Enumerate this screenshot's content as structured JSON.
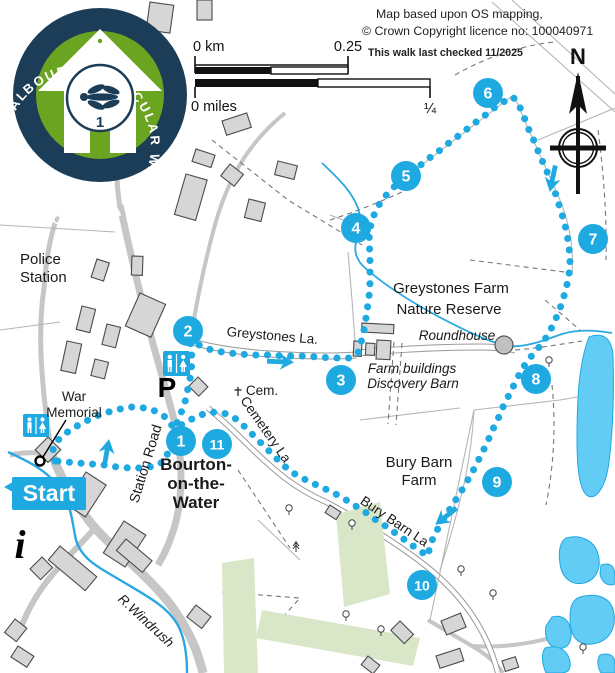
{
  "header": {
    "credit_line1": "Map based upon OS mapping,",
    "credit_line2": "© Crown Copyright licence no: 100040971",
    "checked": "This walk last checked 11/2025"
  },
  "scalebar": {
    "km_zero": "0 km",
    "km_max": "0.25",
    "miles_zero": "0 miles",
    "miles_max": "¼"
  },
  "compass": {
    "label": "N"
  },
  "badge": {
    "ring_text": "BOURTON CIRCULAR WALK • BOURTON CIRCULAR WALK •",
    "number": "1"
  },
  "start_label": "Start",
  "colors": {
    "route": "#1fa9e1",
    "lake": "#63ccf5",
    "green_area": "#d9e7c8",
    "building": "#d6d6d6",
    "road": "#c6c6c6",
    "badge_navy": "#1c3d57",
    "badge_green": "#6aa421"
  },
  "waypoints": [
    {
      "n": "1",
      "x": 181,
      "y": 441
    },
    {
      "n": "2",
      "x": 188,
      "y": 331
    },
    {
      "n": "3",
      "x": 341,
      "y": 380
    },
    {
      "n": "4",
      "x": 356,
      "y": 228
    },
    {
      "n": "5",
      "x": 406,
      "y": 176
    },
    {
      "n": "6",
      "x": 488,
      "y": 93
    },
    {
      "n": "7",
      "x": 593,
      "y": 239
    },
    {
      "n": "8",
      "x": 536,
      "y": 379
    },
    {
      "n": "9",
      "x": 497,
      "y": 482
    },
    {
      "n": "10",
      "x": 422,
      "y": 585
    },
    {
      "n": "11",
      "x": 217,
      "y": 444
    }
  ],
  "map_labels": [
    {
      "text": "Police",
      "x": 20,
      "y": 264,
      "size": 15,
      "cls": "lbl"
    },
    {
      "text": "Station",
      "x": 20,
      "y": 282,
      "size": 15,
      "cls": "lbl"
    },
    {
      "text": "War",
      "x": 74,
      "y": 401,
      "size": 13.5,
      "cls": "lbl",
      "anchor": "middle"
    },
    {
      "text": "Memorial",
      "x": 74,
      "y": 417,
      "size": 13.5,
      "cls": "lbl",
      "anchor": "middle"
    },
    {
      "text": "Bourton-",
      "x": 196,
      "y": 470,
      "size": 17,
      "cls": "lbl-bold",
      "anchor": "middle"
    },
    {
      "text": "on-the-",
      "x": 196,
      "y": 489,
      "size": 17,
      "cls": "lbl-bold",
      "anchor": "middle"
    },
    {
      "text": "Water",
      "x": 196,
      "y": 508,
      "size": 17,
      "cls": "lbl-bold",
      "anchor": "middle"
    },
    {
      "text": "Station Road",
      "x": 150,
      "y": 465,
      "size": 14,
      "cls": "lbl",
      "anchor": "middle",
      "rot": -73
    },
    {
      "text": "Greystones La.",
      "x": 272,
      "y": 340,
      "size": 13.5,
      "cls": "lbl",
      "anchor": "middle",
      "rot": 5
    },
    {
      "text": "Cem.",
      "x": 262,
      "y": 395,
      "size": 13.5,
      "cls": "lbl",
      "anchor": "middle"
    },
    {
      "text": "Cemetery La",
      "x": 262,
      "y": 432,
      "size": 13.5,
      "cls": "lbl",
      "anchor": "middle",
      "rot": 55
    },
    {
      "text": "Greystones Farm",
      "x": 451,
      "y": 293,
      "size": 15,
      "cls": "lbl",
      "anchor": "middle"
    },
    {
      "text": "Nature Reserve",
      "x": 449,
      "y": 314,
      "size": 15,
      "cls": "lbl",
      "anchor": "middle"
    },
    {
      "text": "Roundhouse",
      "x": 457,
      "y": 340,
      "size": 13.5,
      "cls": "lbl-italic",
      "anchor": "middle"
    },
    {
      "text": "Farm buildings",
      "x": 412,
      "y": 373,
      "size": 13.5,
      "cls": "lbl-italic",
      "anchor": "middle"
    },
    {
      "text": "Discovery Barn",
      "x": 413,
      "y": 388,
      "size": 13.5,
      "cls": "lbl-italic",
      "anchor": "middle"
    },
    {
      "text": "Bury Barn",
      "x": 419,
      "y": 467,
      "size": 15,
      "cls": "lbl",
      "anchor": "middle"
    },
    {
      "text": "Farm",
      "x": 419,
      "y": 485,
      "size": 15,
      "cls": "lbl",
      "anchor": "middle"
    },
    {
      "text": "Bury Barn La",
      "x": 392,
      "y": 525,
      "size": 13.5,
      "cls": "lbl",
      "anchor": "middle",
      "rot": 34
    },
    {
      "text": "R.Windrush",
      "x": 143,
      "y": 624,
      "size": 13.5,
      "cls": "lbl-italic",
      "anchor": "middle",
      "rot": 43
    },
    {
      "text": "P",
      "x": 167,
      "y": 397,
      "size": 28,
      "cls": "lbl-heavy",
      "anchor": "middle"
    },
    {
      "text": "i",
      "x": 20,
      "y": 558,
      "size": 40,
      "cls": "lbl-info",
      "anchor": "middle"
    }
  ],
  "route": {
    "color": "#1fa9e1",
    "main_path": "M 55,461 L 53,449 L 59,439 L 70,430 L 84,422 L 99,415 L 115,410 L 131,407 L 146,408 L 158,412 L 168,419 L 174,429 L 180,416 L 185,402 L 188,388 L 191,374 L 192,360 L 191,346 L 189,335 L 197,344 L 208,349 L 222,352 L 238,354 L 254,355 L 270,355 L 286,356 L 302,356 L 318,357 L 334,358 L 349,358 L 358,353 L 362,339 L 365,325 L 367,311 L 369,297 L 370,283 L 370,269 L 370,255 L 369,241 L 370,228 L 374,215 L 380,203 L 388,193 L 397,184 L 406,177 L 417,168 L 428,159 L 439,151 L 450,142 L 461,134 L 472,125 L 483,117 L 494,108 L 505,101 L 513,97 L 519,105 L 524,117 L 529,130 L 535,143 L 540,156 L 546,169 L 551,182 L 556,195 L 560,208 L 564,221 L 567,234 L 569,247 L 570,261 L 569,275 L 566,289 L 562,303 L 557,316 L 551,329 L 544,341 L 536,351 L 528,360 L 521,371 L 515,383 L 509,395 L 503,407 L 498,419 L 492,431 L 487,443 L 481,455 L 475,467 L 469,478 L 462,490 L 455,501 L 448,512 L 441,523 L 435,534 L 430,545 L 428,556 L 420,551 L 409,543 L 398,535 L 387,527 L 376,520 L 365,512 L 354,505 L 343,498 L 332,492 L 321,487 L 310,482 L 300,477 L 290,471 L 281,463 L 272,454 L 263,445 L 254,436 L 245,427 L 236,419 L 227,414 L 217,412 L 206,413 L 196,417 L 186,422 L 178,427",
    "return_path": "M 174,432 L 170,442 L 168,452 L 165,461 L 155,466 L 143,468 L 130,468 L 117,467 L 104,465 L 91,464 L 78,463 L 66,462 L 57,461",
    "arrows": [
      {
        "x": 108,
        "y": 445,
        "rot": -80
      },
      {
        "x": 288,
        "y": 362,
        "rot": 2
      },
      {
        "x": 551,
        "y": 186,
        "rot": 102
      },
      {
        "x": 440,
        "y": 521,
        "rot": 142
      },
      {
        "x": 10,
        "y": 487,
        "rot": 180
      }
    ]
  }
}
